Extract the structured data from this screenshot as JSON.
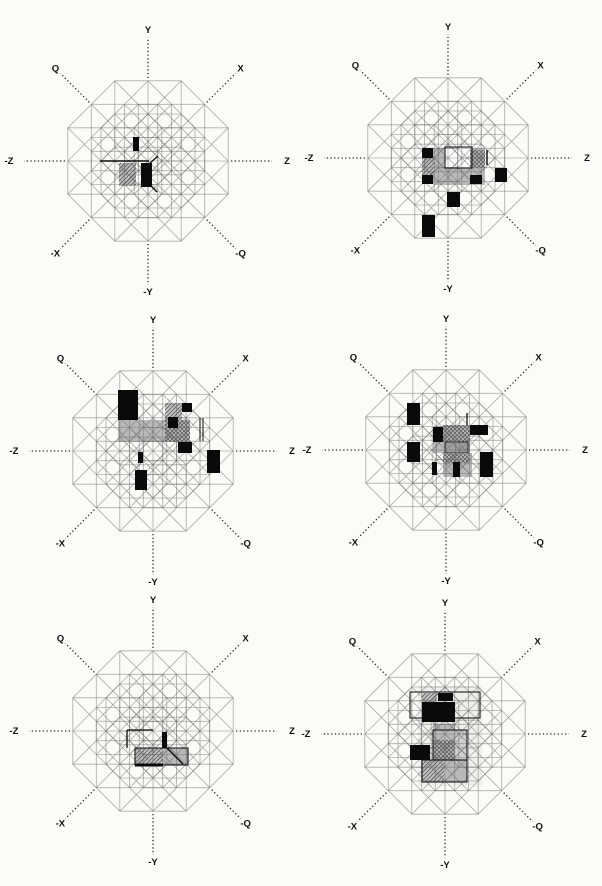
{
  "figure": {
    "background": "#fbfbf8",
    "description": "Six octagonal 4D hypercube lattice projections with filled memory cells"
  },
  "axes": {
    "labels": [
      {
        "label": "Y",
        "angle": 90
      },
      {
        "label": "X",
        "angle": 45
      },
      {
        "label": "Q",
        "angle": 135
      },
      {
        "label": "Z",
        "angle": 0
      },
      {
        "label": "-Z",
        "angle": 180
      },
      {
        "label": "-X",
        "angle": 225
      },
      {
        "label": "-Q",
        "angle": 315
      },
      {
        "label": "-Y",
        "angle": 270
      }
    ],
    "line_color": "#2a2a2a",
    "label_color": "#111111"
  },
  "lattice": {
    "unit": 33.2,
    "color": "#6f6f6f",
    "opacity": 0.55,
    "width": 0.85,
    "axis_inner_radius": 83,
    "axis_outer_radius": 124,
    "label_radius_horizontal": 139,
    "label_radius_other": 131
  },
  "styles": {
    "black": "#0a0a0a",
    "gray": "#b9b9b9",
    "grayLight": "#cfcfcf",
    "grayDark": "#9e9e9e",
    "white": "#ffffff",
    "wash": "#efefec",
    "hatchBg": "#c6c6c6",
    "hatchLine": "#5e5e5e",
    "outline": "#1c1c1c"
  },
  "panels": [
    {
      "name": "projection-1",
      "x": 0,
      "y": 0,
      "w": 301,
      "h": 295,
      "center": {
        "x": 148,
        "y": 161
      },
      "cells": [
        {
          "kind": "rect",
          "style": "hatch",
          "x": 119,
          "y": 163,
          "w": 17,
          "h": 23
        },
        {
          "kind": "rect",
          "style": "black",
          "x": 133,
          "y": 137,
          "w": 6,
          "h": 14
        },
        {
          "kind": "rect",
          "style": "black",
          "x": 141,
          "y": 163,
          "w": 11,
          "h": 24
        },
        {
          "kind": "line",
          "x1": 100,
          "y1": 161,
          "x2": 149,
          "y2": 161,
          "w": 1.6
        },
        {
          "kind": "line",
          "x1": 150,
          "y1": 163,
          "x2": 158,
          "y2": 156,
          "w": 1.4
        },
        {
          "kind": "line",
          "x1": 151,
          "y1": 186,
          "x2": 157,
          "y2": 192,
          "w": 1.4
        }
      ]
    },
    {
      "name": "projection-2",
      "x": 301,
      "y": 0,
      "w": 301,
      "h": 295,
      "center": {
        "x": 147,
        "y": 158
      },
      "cells": [
        {
          "kind": "rect",
          "style": "gray",
          "x": 132,
          "y": 148,
          "w": 52,
          "h": 37
        },
        {
          "kind": "rect",
          "style": "white",
          "x": 144,
          "y": 148,
          "w": 27,
          "h": 20
        },
        {
          "kind": "rect",
          "style": "crosshatch",
          "x": 169,
          "y": 150,
          "w": 15,
          "h": 18
        },
        {
          "kind": "rect",
          "style": "hatch",
          "x": 121,
          "y": 158,
          "w": 13,
          "h": 17
        },
        {
          "kind": "rect",
          "style": "outline",
          "x": 144,
          "y": 147,
          "w": 27,
          "h": 21
        },
        {
          "kind": "rect",
          "style": "black",
          "x": 121,
          "y": 148,
          "w": 11,
          "h": 10
        },
        {
          "kind": "rect",
          "style": "black",
          "x": 121,
          "y": 175,
          "w": 11,
          "h": 9
        },
        {
          "kind": "rect",
          "style": "black",
          "x": 169,
          "y": 175,
          "w": 12,
          "h": 9
        },
        {
          "kind": "rect",
          "style": "black",
          "x": 194,
          "y": 168,
          "w": 12,
          "h": 14
        },
        {
          "kind": "line",
          "x1": 186,
          "y1": 150,
          "x2": 186,
          "y2": 165,
          "w": 1.4
        },
        {
          "kind": "rect",
          "style": "black",
          "x": 146,
          "y": 192,
          "w": 13,
          "h": 15
        },
        {
          "kind": "rect",
          "style": "black",
          "x": 121,
          "y": 215,
          "w": 13,
          "h": 22
        }
      ]
    },
    {
      "name": "projection-3",
      "x": 0,
      "y": 295,
      "w": 301,
      "h": 295,
      "center": {
        "x": 153,
        "y": 156
      },
      "cells": [
        {
          "kind": "rect",
          "style": "gray",
          "x": 118,
          "y": 125,
          "w": 72,
          "h": 22
        },
        {
          "kind": "rect",
          "style": "crosshatch",
          "x": 165,
          "y": 125,
          "w": 25,
          "h": 22
        },
        {
          "kind": "rect",
          "style": "hatch",
          "x": 165,
          "y": 108,
          "w": 17,
          "h": 17
        },
        {
          "kind": "rect",
          "style": "black",
          "x": 118,
          "y": 95,
          "w": 20,
          "h": 30
        },
        {
          "kind": "rect",
          "style": "black",
          "x": 182,
          "y": 108,
          "w": 10,
          "h": 9
        },
        {
          "kind": "rect",
          "style": "black",
          "x": 168,
          "y": 122,
          "w": 10,
          "h": 11
        },
        {
          "kind": "rect",
          "style": "black",
          "x": 178,
          "y": 147,
          "w": 14,
          "h": 11
        },
        {
          "kind": "rect",
          "style": "black",
          "x": 138,
          "y": 157,
          "w": 5,
          "h": 11
        },
        {
          "kind": "rect",
          "style": "black",
          "x": 207,
          "y": 155,
          "w": 13,
          "h": 23
        },
        {
          "kind": "rect",
          "style": "black",
          "x": 135,
          "y": 175,
          "w": 12,
          "h": 20
        },
        {
          "kind": "line",
          "x1": 200,
          "y1": 123,
          "x2": 200,
          "y2": 146,
          "w": 1
        },
        {
          "kind": "line",
          "x1": 203,
          "y1": 123,
          "x2": 203,
          "y2": 146,
          "w": 1
        }
      ]
    },
    {
      "name": "projection-4",
      "x": 301,
      "y": 295,
      "w": 301,
      "h": 295,
      "center": {
        "x": 145,
        "y": 155
      },
      "cells": [
        {
          "kind": "rect",
          "style": "crosshatch",
          "x": 142,
          "y": 130,
          "w": 27,
          "h": 17
        },
        {
          "kind": "rect",
          "style": "gray",
          "x": 132,
          "y": 147,
          "w": 37,
          "h": 11
        },
        {
          "kind": "rect",
          "style": "grayDark",
          "x": 144,
          "y": 147,
          "w": 23,
          "h": 11,
          "stroke": true
        },
        {
          "kind": "rect",
          "style": "gray",
          "x": 142,
          "y": 158,
          "w": 29,
          "h": 24
        },
        {
          "kind": "rect",
          "style": "crosshatch",
          "x": 142,
          "y": 158,
          "w": 26,
          "h": 10
        },
        {
          "kind": "rect",
          "style": "black",
          "x": 106,
          "y": 108,
          "w": 13,
          "h": 22
        },
        {
          "kind": "rect",
          "style": "black",
          "x": 106,
          "y": 147,
          "w": 13,
          "h": 20
        },
        {
          "kind": "rect",
          "style": "black",
          "x": 132,
          "y": 132,
          "w": 10,
          "h": 15
        },
        {
          "kind": "rect",
          "style": "black",
          "x": 169,
          "y": 130,
          "w": 18,
          "h": 10
        },
        {
          "kind": "rect",
          "style": "black",
          "x": 152,
          "y": 167,
          "w": 7,
          "h": 15
        },
        {
          "kind": "rect",
          "style": "black",
          "x": 131,
          "y": 167,
          "w": 5,
          "h": 13
        },
        {
          "kind": "rect",
          "style": "black",
          "x": 179,
          "y": 157,
          "w": 13,
          "h": 25
        },
        {
          "kind": "line",
          "x1": 166,
          "y1": 118,
          "x2": 166,
          "y2": 130,
          "w": 1.2
        }
      ]
    },
    {
      "name": "projection-5",
      "x": 0,
      "y": 590,
      "w": 301,
      "h": 296,
      "center": {
        "x": 153,
        "y": 141
      },
      "cells": [
        {
          "kind": "rect",
          "style": "gray",
          "x": 135,
          "y": 158,
          "w": 53,
          "h": 17
        },
        {
          "kind": "rect",
          "style": "hatch",
          "x": 135,
          "y": 158,
          "w": 28,
          "h": 17
        },
        {
          "kind": "rect",
          "style": "outline",
          "x": 135,
          "y": 158,
          "w": 53,
          "h": 17
        },
        {
          "kind": "rect",
          "style": "black",
          "x": 162,
          "y": 142,
          "w": 5,
          "h": 16
        },
        {
          "kind": "line",
          "x1": 127,
          "y1": 140,
          "x2": 153,
          "y2": 140,
          "w": 1.3
        },
        {
          "kind": "line",
          "x1": 127,
          "y1": 140,
          "x2": 127,
          "y2": 158,
          "w": 1.3
        },
        {
          "kind": "line",
          "x1": 135,
          "y1": 175,
          "x2": 163,
          "y2": 175,
          "w": 3
        },
        {
          "kind": "line",
          "x1": 167,
          "y1": 158,
          "x2": 183,
          "y2": 174,
          "w": 1.5
        }
      ]
    },
    {
      "name": "projection-6",
      "x": 301,
      "y": 590,
      "w": 301,
      "h": 296,
      "center": {
        "x": 144,
        "y": 144
      },
      "cells": [
        {
          "kind": "rect",
          "style": "wash",
          "x": 117,
          "y": 96,
          "w": 64,
          "h": 100
        },
        {
          "kind": "rect",
          "style": "gray",
          "x": 132,
          "y": 134,
          "w": 22,
          "h": 56
        },
        {
          "kind": "rect",
          "style": "grayLight",
          "x": 154,
          "y": 140,
          "w": 12,
          "h": 50
        },
        {
          "kind": "rect",
          "style": "crosshatch",
          "x": 132,
          "y": 150,
          "w": 22,
          "h": 22
        },
        {
          "kind": "rect",
          "style": "gray",
          "x": 121,
          "y": 170,
          "w": 45,
          "h": 22
        },
        {
          "kind": "rect",
          "style": "hatch",
          "x": 121,
          "y": 170,
          "w": 22,
          "h": 22
        },
        {
          "kind": "rect",
          "style": "hatch",
          "x": 121,
          "y": 103,
          "w": 15,
          "h": 10
        },
        {
          "kind": "rect",
          "style": "outline",
          "x": 109,
          "y": 102,
          "w": 70,
          "h": 26
        },
        {
          "kind": "rect",
          "style": "outline",
          "x": 132,
          "y": 140,
          "w": 34,
          "h": 30
        },
        {
          "kind": "rect",
          "style": "outline",
          "x": 121,
          "y": 170,
          "w": 45,
          "h": 22
        },
        {
          "kind": "rect",
          "style": "black",
          "x": 137,
          "y": 103,
          "w": 15,
          "h": 8
        },
        {
          "kind": "rect",
          "style": "black",
          "x": 121,
          "y": 112,
          "w": 33,
          "h": 20
        },
        {
          "kind": "rect",
          "style": "black",
          "x": 109,
          "y": 155,
          "w": 20,
          "h": 15
        }
      ]
    }
  ]
}
